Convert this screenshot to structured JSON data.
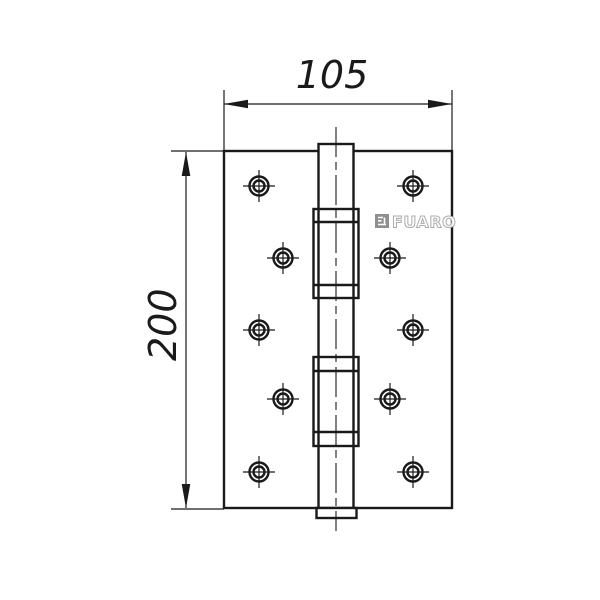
{
  "drawing": {
    "type": "technical-drawing",
    "subject": "door-hinge-front-view",
    "brand": "FUARO",
    "width_dimension": "105",
    "height_dimension": "200",
    "line_color": "#1a1a1a",
    "logo_text_color": "#ababab",
    "logo_icon_color": "#8f8f8f",
    "background_color": "#ffffff",
    "screw_holes": [
      [
        259,
        186
      ],
      [
        413,
        186
      ],
      [
        283,
        258
      ],
      [
        390,
        258
      ],
      [
        259,
        330
      ],
      [
        413,
        330
      ],
      [
        283,
        399
      ],
      [
        390,
        399
      ],
      [
        259,
        472
      ],
      [
        413,
        472
      ]
    ]
  }
}
